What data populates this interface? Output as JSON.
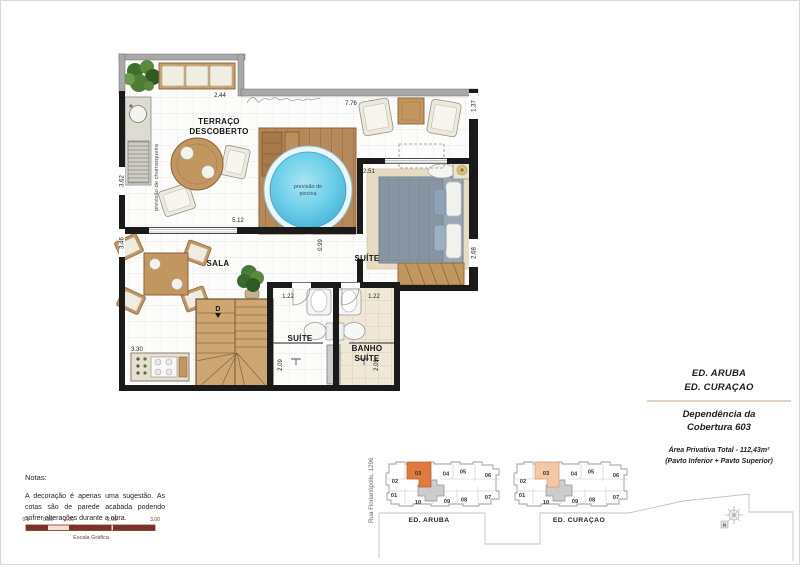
{
  "plan": {
    "rooms": {
      "terraco_l1": "TERRAÇO",
      "terraco_l2": "DESCOBERTO",
      "sala": "SALA",
      "suite": "SUÍTE",
      "suite_bath": "SUÍTE",
      "banho_l1": "BANHO",
      "banho_l2": "SUÍTE"
    },
    "labels": {
      "pool_l1": "previsão de",
      "pool_l2": "piscina",
      "churrasqueira": "previsão de churrasqueira",
      "stair": "D"
    },
    "dims": {
      "niche": "2.44",
      "terrace_top": "7.76",
      "terrace_right": "1.37",
      "suite_top": "2.51",
      "suite_right": "2.68",
      "sala_top": "5.12",
      "left_upper": "3.62",
      "left_lower": "3.46",
      "hall": "0.99",
      "bath1": "1.22",
      "bath2": "1.22",
      "bath1_depth": "2.09",
      "bath2_depth": "2.09",
      "kitchen": "3.30"
    }
  },
  "title_block": {
    "building1": "ED. ARUBA",
    "building2": "ED. CURAÇAO",
    "unit_l1": "Dependência da",
    "unit_l2": "Cobertura 603",
    "area": "Área Privativa Total - 112,43m²",
    "area_note": "(Pavto Inferior + Pavto Superior)"
  },
  "notes": {
    "heading": "Notas:",
    "body": "A decoração é apenas uma sugestão. As cotas são de parede acabada podendo sofrer alterações durante a obra."
  },
  "scale_bar": {
    "t0": "0.0",
    "t1": "0.50",
    "t2": "1.00",
    "t3": "2.00",
    "t4": "3.00",
    "caption": "Escala Gráfica"
  },
  "site": {
    "street": "Rua Florianópolis, 1296",
    "north": "N",
    "buildings": [
      {
        "name": "ED. ARUBA",
        "highlight": "#e07a3e",
        "units": {
          "u03": "03",
          "u04": "04",
          "u05": "05",
          "u06": "06",
          "u02": "02",
          "u01": "01",
          "u10": "10",
          "u09": "09",
          "u08": "08",
          "u07": "07"
        }
      },
      {
        "name": "ED. CURAÇAO",
        "highlight": "#f4c8a4",
        "units": {
          "u03": "03",
          "u04": "04",
          "u05": "05",
          "u06": "06",
          "u02": "02",
          "u01": "01",
          "u10": "10",
          "u09": "09",
          "u08": "08",
          "u07": "07"
        }
      }
    ]
  },
  "colors": {
    "wall": "#1a1a1a",
    "parapet": "#a8a8a8",
    "wood": "#c2975f",
    "deck": "#b5895a",
    "pool": "#5fc4e4",
    "scale_dark": "#7a332a"
  }
}
